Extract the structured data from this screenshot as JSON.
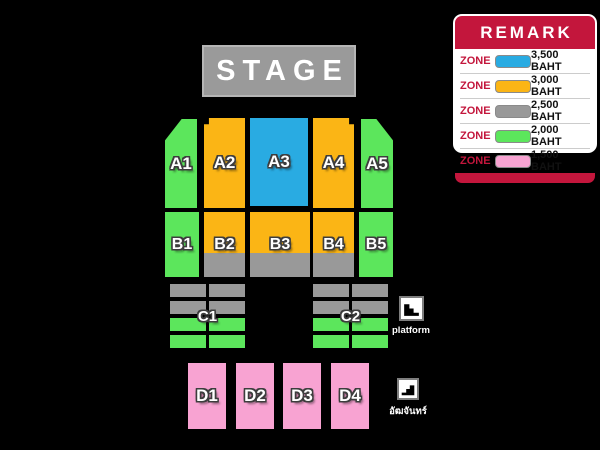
{
  "stage": {
    "label": "STAGE"
  },
  "zones": {
    "row_a": [
      {
        "id": "A1",
        "tier": "green"
      },
      {
        "id": "A2",
        "tier": "yellow"
      },
      {
        "id": "A3",
        "tier": "blue"
      },
      {
        "id": "A4",
        "tier": "yellow"
      },
      {
        "id": "A5",
        "tier": "green"
      }
    ],
    "row_b": [
      {
        "id": "B1",
        "tier": "green"
      },
      {
        "id": "B2",
        "tier": "yellow-gray"
      },
      {
        "id": "B3",
        "tier": "yellow-gray"
      },
      {
        "id": "B4",
        "tier": "yellow-gray"
      },
      {
        "id": "B5",
        "tier": "green"
      }
    ],
    "row_c": [
      {
        "id": "C1",
        "tier": "gray-green"
      },
      {
        "id": "C2",
        "tier": "gray-green"
      }
    ],
    "row_d": [
      {
        "id": "D1",
        "tier": "pink"
      },
      {
        "id": "D2",
        "tier": "pink"
      },
      {
        "id": "D3",
        "tier": "pink"
      },
      {
        "id": "D4",
        "tier": "pink"
      }
    ]
  },
  "markers": {
    "platform": {
      "label": "platform",
      "icon": "stairs-descending-right-icon"
    },
    "grandstand": {
      "label": "อัฒจันทร์",
      "icon": "stairs-descending-left-icon"
    }
  },
  "legend": {
    "title": "REMARK",
    "zone_label": "ZONE",
    "rows": [
      {
        "color": "#29ABE2",
        "price": "3,500 BAHT"
      },
      {
        "color": "#FBB515",
        "price": "3,000 BAHT"
      },
      {
        "color": "#999999",
        "price": "2,500 BAHT"
      },
      {
        "color": "#5CE65C",
        "price": "2,000 BAHT"
      },
      {
        "color": "#F8A3D2",
        "price": "1,500 BAHT"
      }
    ]
  },
  "colors": {
    "background": "#000000",
    "blue": "#29ABE2",
    "yellow": "#FBB515",
    "gray": "#999999",
    "green": "#5CE65C",
    "pink": "#F8A3D2",
    "legend_red": "#C3163C",
    "stage_gray": "#9A9A9A"
  }
}
